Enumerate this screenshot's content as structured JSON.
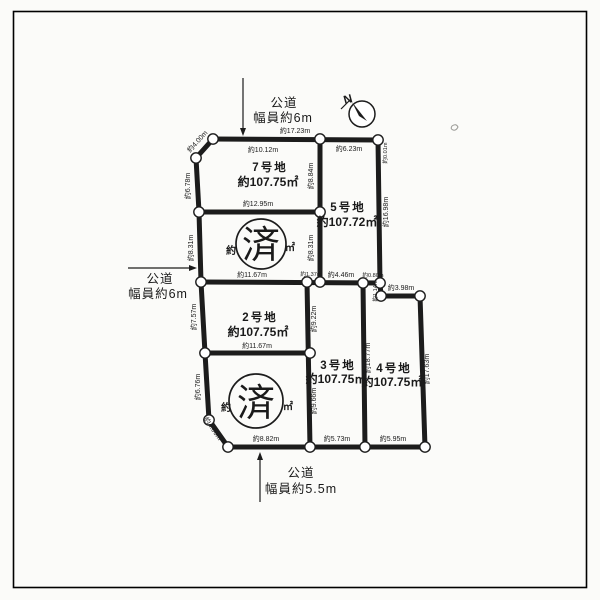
{
  "diagram_type": "land-subdivision-plat",
  "colors": {
    "ink": "#1c1c1c",
    "paper": "#fbfbf9"
  },
  "roads": {
    "top": {
      "name": "公道",
      "width": "幅員約6m"
    },
    "left": {
      "name": "公道",
      "width": "幅員約6m"
    },
    "bottom": {
      "name": "公道",
      "width": "幅員約5.5m"
    }
  },
  "compass": {
    "label": "N"
  },
  "plots": [
    {
      "id": "7",
      "name": "7号地",
      "area": "約107.75㎡"
    },
    {
      "id": "5",
      "name": "5号地",
      "area": "約107.72㎡"
    },
    {
      "id": "2",
      "name": "2号地",
      "area": "約107.75㎡"
    },
    {
      "id": "3",
      "name": "3号地",
      "area": "約107.75㎡"
    },
    {
      "id": "4",
      "name": "4号地",
      "area": "約107.75㎡"
    }
  ],
  "sold_plots": [
    {
      "stamp": "済",
      "visible_prefix": "約",
      "visible_suffix": "㎡"
    },
    {
      "stamp": "済",
      "visible_prefix": "約",
      "visible_suffix": "㎡"
    }
  ],
  "dimensions": {
    "top_total": "約17.23m",
    "p7_top": "約10.12m",
    "p5_top": "約6.23m",
    "corner_right_top": "約0.01m",
    "p5_right": "約16.98m",
    "corner_top_left": "約4.00m",
    "left_upper": "約6.78m",
    "divider_7_5": "約8.84m",
    "p7_bottom": "約12.95m",
    "left_mid_upper": "約8.31m",
    "divider_6_5": "約8.31m",
    "p6_bottom": "約11.67m",
    "seg_1_37": "約1.37m",
    "p5_bottom": "約4.46m",
    "seg_0_80": "約0.80m",
    "notch_vertical": "約1.14m",
    "p4_top": "約3.98m",
    "left_mid_lower": "約7.57m",
    "divider_2_3": "約9.22m",
    "p2_bottom": "約11.67m",
    "left_lower": "約6.76m",
    "corner_bottom_left": "約4.00m",
    "divider_1_3": "約9.66m",
    "divider_3_4": "約18.77m",
    "p4_right": "約17.63m",
    "p1_bottom": "約8.82m",
    "p3_bottom": "約5.73m",
    "p4_bottom": "約5.95m"
  }
}
